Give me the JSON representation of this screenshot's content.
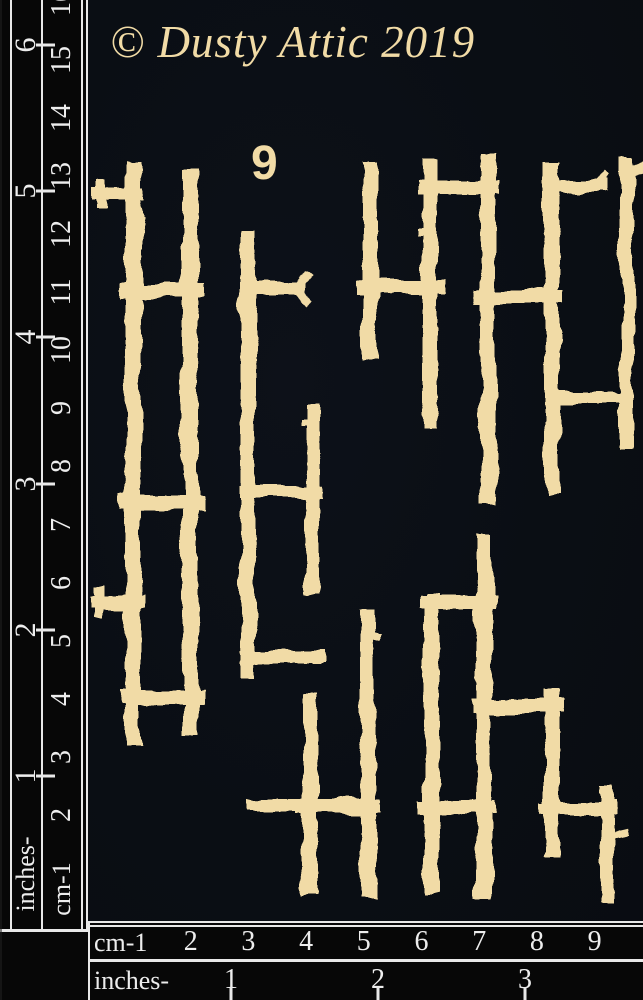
{
  "header": {
    "copyright": "© Dusty Attic 2019",
    "sheet_number": "9"
  },
  "colors": {
    "chipboard": "#f1dba6",
    "background": "#0b0e14",
    "ruler_background": "#070707",
    "ruler_lines": "#e8e8e8",
    "ruler_text": "#ededed"
  },
  "left_ruler": {
    "inches_label": "inches-",
    "cm_label": "cm-1",
    "inches_numbers": [
      "1",
      "2",
      "3",
      "4",
      "5",
      "6"
    ],
    "cm_numbers": [
      "2",
      "3",
      "4",
      "5",
      "6",
      "7",
      "8",
      "9",
      "10",
      "11",
      "12",
      "13",
      "14",
      "15",
      "16"
    ]
  },
  "bottom_ruler": {
    "cm_label": "cm-1",
    "cm_numbers": [
      "2",
      "3",
      "4",
      "5",
      "6",
      "7",
      "8",
      "9"
    ],
    "inches_label": "inches-",
    "inches_numbers": [
      "1",
      "2",
      "3"
    ]
  },
  "artwork": {
    "color": "#f1dba6",
    "twig_segments": [
      [
        133,
        168,
        133,
        737,
        16
      ],
      [
        98,
        193,
        137,
        193,
        13
      ],
      [
        100,
        184,
        100,
        204,
        10
      ],
      [
        96,
        603,
        137,
        603,
        13
      ],
      [
        98,
        592,
        98,
        614,
        10
      ],
      [
        190,
        177,
        190,
        727,
        16
      ],
      [
        248,
        236,
        248,
        670,
        15
      ],
      [
        312,
        412,
        312,
        586,
        15
      ],
      [
        303,
        425,
        313,
        425,
        8
      ],
      [
        127,
        290,
        197,
        290,
        14
      ],
      [
        127,
        503,
        197,
        503,
        14
      ],
      [
        127,
        698,
        197,
        698,
        14
      ],
      [
        248,
        288,
        299,
        288,
        13
      ],
      [
        297,
        288,
        307,
        276,
        8
      ],
      [
        297,
        288,
        307,
        300,
        8
      ],
      [
        246,
        492,
        316,
        492,
        13
      ],
      [
        246,
        657,
        317,
        657,
        13
      ],
      [
        370,
        169,
        370,
        353,
        15
      ],
      [
        430,
        167,
        430,
        421,
        15
      ],
      [
        421,
        231,
        431,
        231,
        8
      ],
      [
        488,
        161,
        488,
        496,
        15
      ],
      [
        552,
        169,
        552,
        489,
        15
      ],
      [
        627,
        166,
        627,
        441,
        14
      ],
      [
        627,
        173,
        642,
        167,
        9
      ],
      [
        363,
        287,
        437,
        287,
        14
      ],
      [
        424,
        187,
        493,
        187,
        13
      ],
      [
        481,
        296,
        557,
        296,
        14
      ],
      [
        552,
        186,
        601,
        186,
        12
      ],
      [
        598,
        184,
        604,
        176,
        7
      ],
      [
        552,
        397,
        626,
        397,
        12
      ],
      [
        310,
        699,
        310,
        888,
        15
      ],
      [
        368,
        617,
        368,
        891,
        15
      ],
      [
        368,
        636,
        378,
        636,
        8
      ],
      [
        432,
        601,
        432,
        886,
        15
      ],
      [
        484,
        542,
        484,
        891,
        16
      ],
      [
        552,
        696,
        552,
        852,
        15
      ],
      [
        427,
        602,
        489,
        602,
        13
      ],
      [
        252,
        805,
        314,
        805,
        12
      ],
      [
        303,
        806,
        373,
        806,
        14
      ],
      [
        425,
        808,
        489,
        808,
        14
      ],
      [
        479,
        706,
        557,
        706,
        14
      ],
      [
        547,
        808,
        611,
        808,
        12
      ],
      [
        607,
        791,
        607,
        896,
        13
      ],
      [
        607,
        837,
        624,
        833,
        7
      ]
    ]
  }
}
